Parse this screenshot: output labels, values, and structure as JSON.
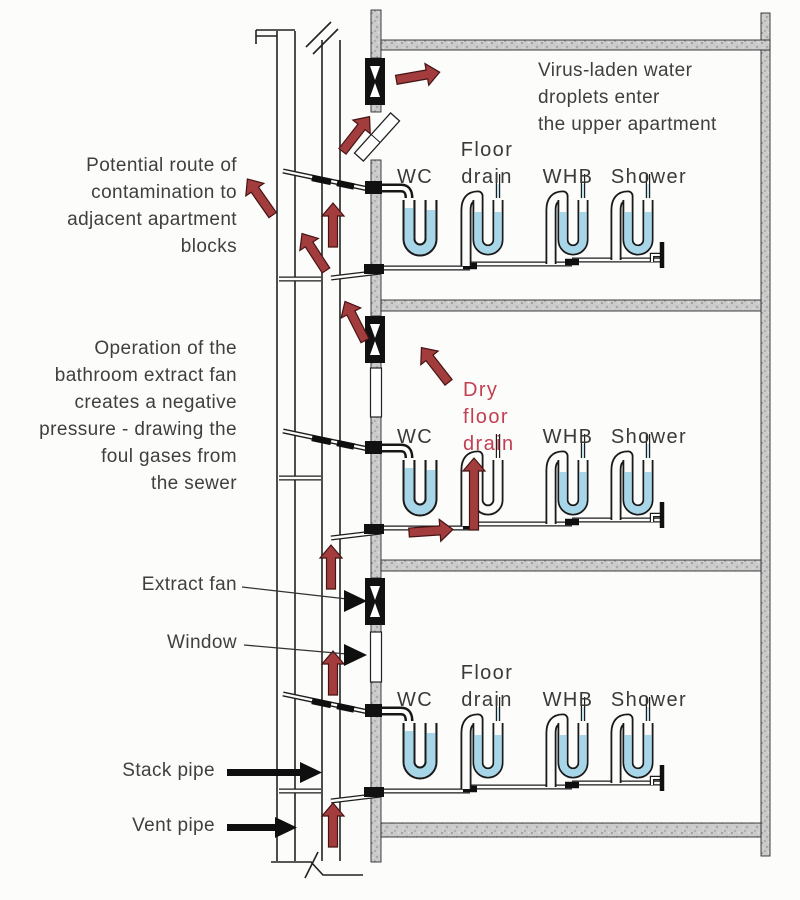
{
  "diagram_title": "Potential plumbing contamination route in apartment block",
  "colors": {
    "arrow_red": "#a33d3d",
    "red_text": "#c23f51",
    "water_blue": "#a7d6e8",
    "concrete_gray": "#cbcbcb",
    "line_black": "#1a1a1a",
    "text_gray": "#3f3f3f"
  },
  "annotations": {
    "contamination_route": {
      "lines": [
        "Potential route of",
        "contamination to",
        "adjacent apartment",
        "blocks"
      ]
    },
    "fan_operation": {
      "lines": [
        "Operation of the",
        "bathroom extract fan",
        "creates a negative",
        "pressure - drawing the",
        "foul gases from",
        "the sewer"
      ]
    },
    "virus_droplets": {
      "lines": [
        "Virus-laden water",
        "droplets enter",
        "the upper apartment"
      ]
    },
    "extract_fan_label": "Extract fan",
    "window_label": "Window",
    "stack_pipe_label": "Stack pipe",
    "vent_pipe_label": "Vent pipe",
    "dry_floor_drain": {
      "lines": [
        "Dry",
        "floor",
        "drain"
      ]
    }
  },
  "floors": [
    {
      "id": "upper",
      "fixtures": {
        "wc": "WC",
        "floor_drain": [
          "Floor",
          "drain"
        ],
        "whb": "WHB",
        "shower": "Shower"
      }
    },
    {
      "id": "middle",
      "fixtures": {
        "wc": "WC",
        "whb": "WHB",
        "shower": "Shower"
      }
    },
    {
      "id": "lower",
      "fixtures": {
        "wc": "WC",
        "floor_drain": [
          "Floor",
          "drain"
        ],
        "whb": "WHB",
        "shower": "Shower"
      }
    }
  ]
}
